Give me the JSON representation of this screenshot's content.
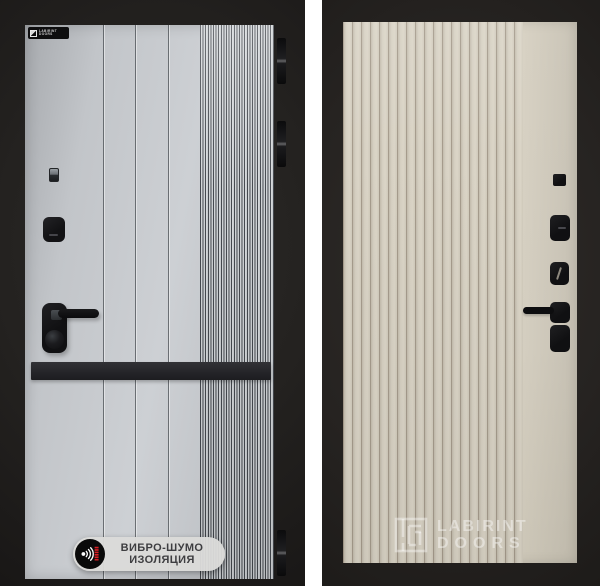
{
  "scene": {
    "description": "Product photo composite of two entrance door panels on dark backgrounds",
    "background_color": "#ffffff"
  },
  "left_door": {
    "style": "gray panel with vertical grooves, fine ribbed strip, black mid band, black hardware",
    "colors": {
      "frame": "#242220",
      "panel": "#c6c9cd",
      "band": "#28282b",
      "hardware": "#121214",
      "rib_dark": "#45494f",
      "rib_light": "#d8dbde"
    },
    "brand_plate": {
      "line1": "LABIRINT",
      "line2": "DOORS"
    },
    "badge": {
      "line1": "ВИБРО-ШУМО",
      "line2": "ИЗОЛЯЦИЯ",
      "icon": "vibration-sound-waves",
      "accent_color": "#d91e24",
      "background": "#dbdbd9",
      "text_color": "#3e3e41"
    },
    "hardware": [
      "peephole",
      "upper-lock",
      "handle-with-lever",
      "round-knob"
    ],
    "hinges_count": 3
  },
  "right_door": {
    "style": "beige fluted panel with black square hardware column",
    "colors": {
      "frame": "#262321",
      "panel": "#d6d0c2",
      "flute_groove": "#a59b8c",
      "hardware": "#141416"
    },
    "hardware": [
      "small-square",
      "lock-block-dash",
      "lock-block-keyway",
      "handle-block-with-lever",
      "lower-block"
    ],
    "watermark": {
      "line1": "LABIRINT",
      "line2": "DOORS",
      "icon": "maze-logo"
    }
  }
}
